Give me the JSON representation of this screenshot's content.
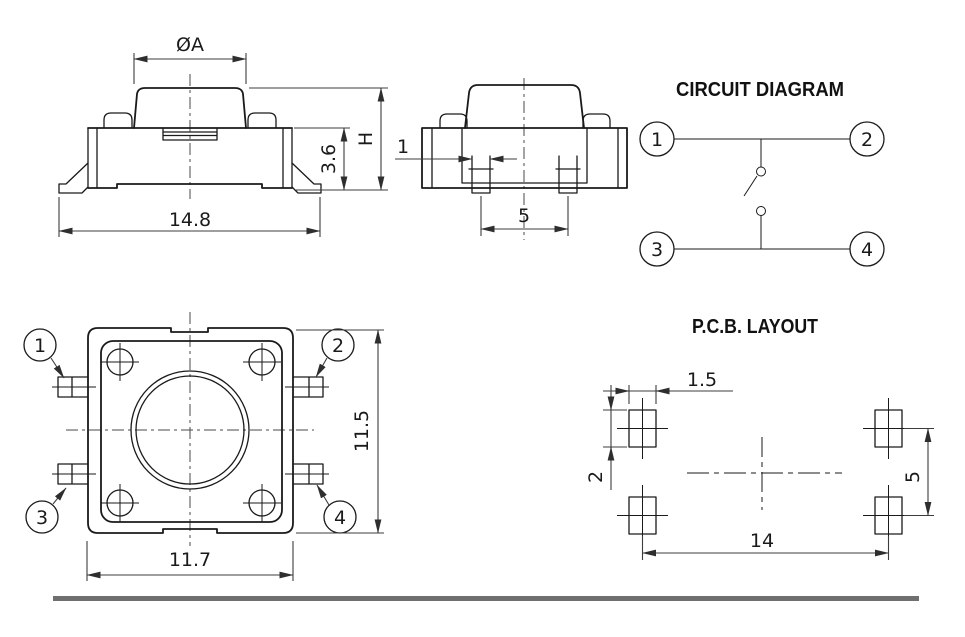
{
  "drawing": {
    "front_view": {
      "dim_cap_diameter": "ØA",
      "dim_overall_width": "14.8",
      "dim_body_height": "3.6",
      "dim_total_height": "H"
    },
    "side_view": {
      "dim_pin_width": "1",
      "dim_pin_pitch": "5"
    },
    "circuit_diagram": {
      "title": "CIRCUIT DIAGRAM",
      "terminals": [
        "1",
        "2",
        "3",
        "4"
      ]
    },
    "top_view": {
      "dim_body_width": "11.7",
      "dim_body_height": "11.5",
      "terminals": [
        "1",
        "2",
        "3",
        "4"
      ]
    },
    "pcb_layout": {
      "title": "P.C.B. LAYOUT",
      "dim_pad_width": "1.5",
      "dim_pad_height": "2",
      "dim_pad_pitch_vertical": "5",
      "dim_pad_pitch_horizontal": "14"
    },
    "colors": {
      "line": "#1a1a1a",
      "dimension": "#3c3c3c",
      "footer_bar": "#6f6f6f",
      "background": "#ffffff"
    }
  }
}
